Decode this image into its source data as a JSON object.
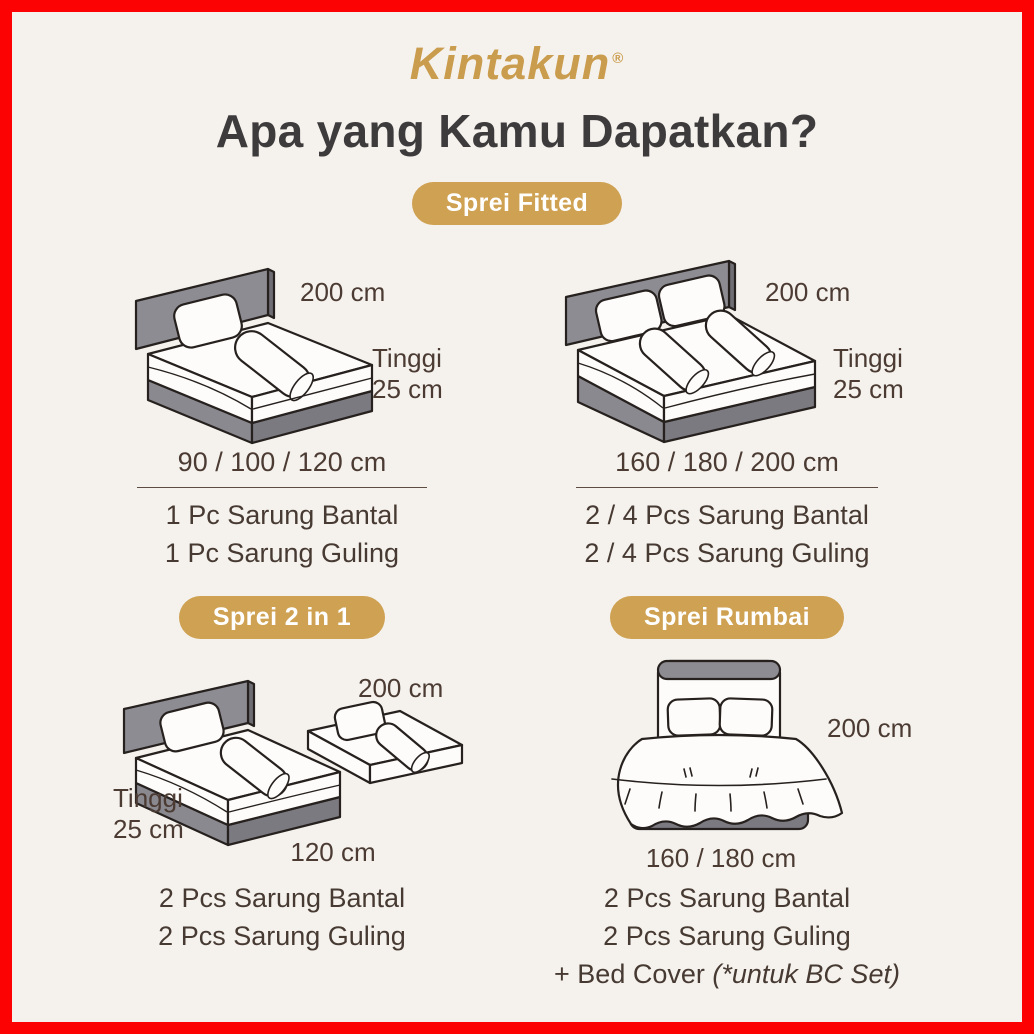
{
  "brand": {
    "name": "Kintakun",
    "reg": "®"
  },
  "title": "Apa yang Kamu Dapatkan?",
  "colors": {
    "border_red": "#fd0202",
    "background": "#f5f2ee",
    "badge_gold": "#cfa152",
    "logo_gold": "#ca9c4d",
    "heading_text": "#3d3b3c",
    "body_text": "#473a32",
    "headboard_gray": "#8d8c92",
    "base_gray": "#7b7a80"
  },
  "fitted": {
    "badge": "Sprei Fitted",
    "single": {
      "illustration": "single-bed-isometric",
      "length_label": "200 cm",
      "height_label_line1": "Tinggi",
      "height_label_line2": "25 cm",
      "sizes": "90 / 100 / 120 cm",
      "items": [
        "1 Pc Sarung Bantal",
        "1 Pc Sarung Guling"
      ]
    },
    "double": {
      "illustration": "double-bed-isometric",
      "length_label": "200 cm",
      "height_label_line1": "Tinggi",
      "height_label_line2": "25 cm",
      "sizes": "160 / 180 / 200 cm",
      "items": [
        "2 / 4 Pcs Sarung Bantal",
        "2 / 4 Pcs Sarung Guling"
      ]
    }
  },
  "two_in_one": {
    "badge": "Sprei 2 in 1",
    "illustration": "two-in-one-bed-isometric",
    "length_label": "200 cm",
    "height_label_line1": "Tinggi",
    "height_label_line2": "25 cm",
    "sizes": "120 cm",
    "items": [
      "2 Pcs Sarung Bantal",
      "2 Pcs Sarung Guling"
    ]
  },
  "rumbai": {
    "badge": "Sprei Rumbai",
    "illustration": "ruffled-bed-front",
    "length_label": "200 cm",
    "sizes": "160 / 180 cm",
    "items": [
      "2 Pcs Sarung Bantal",
      "2 Pcs Sarung Guling"
    ],
    "bed_cover_prefix": "+ Bed Cover ",
    "bed_cover_note": "(*untuk BC Set)"
  }
}
